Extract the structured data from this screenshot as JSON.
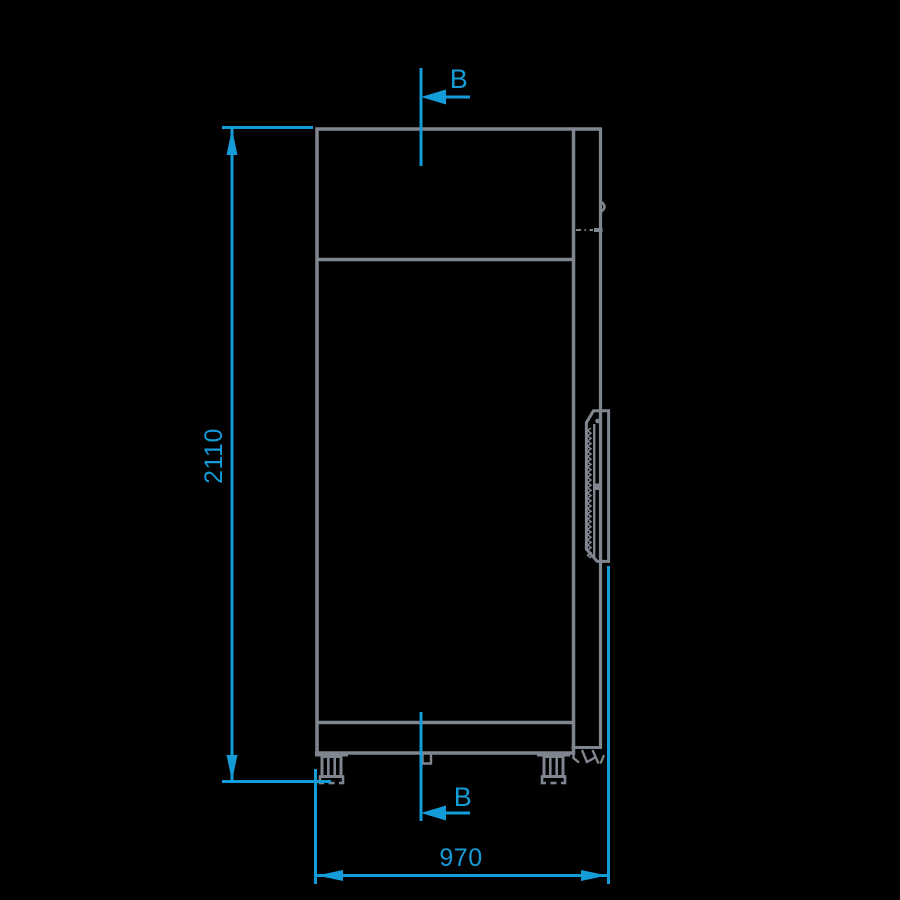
{
  "colors": {
    "background": "#000000",
    "line": "#80868F",
    "dimension": "#149CD9"
  },
  "dimensions": {
    "height": {
      "label": "2110"
    },
    "width": {
      "label": "970"
    }
  },
  "section_markers": {
    "top": {
      "label": "B"
    },
    "bottom": {
      "label": "B"
    }
  }
}
